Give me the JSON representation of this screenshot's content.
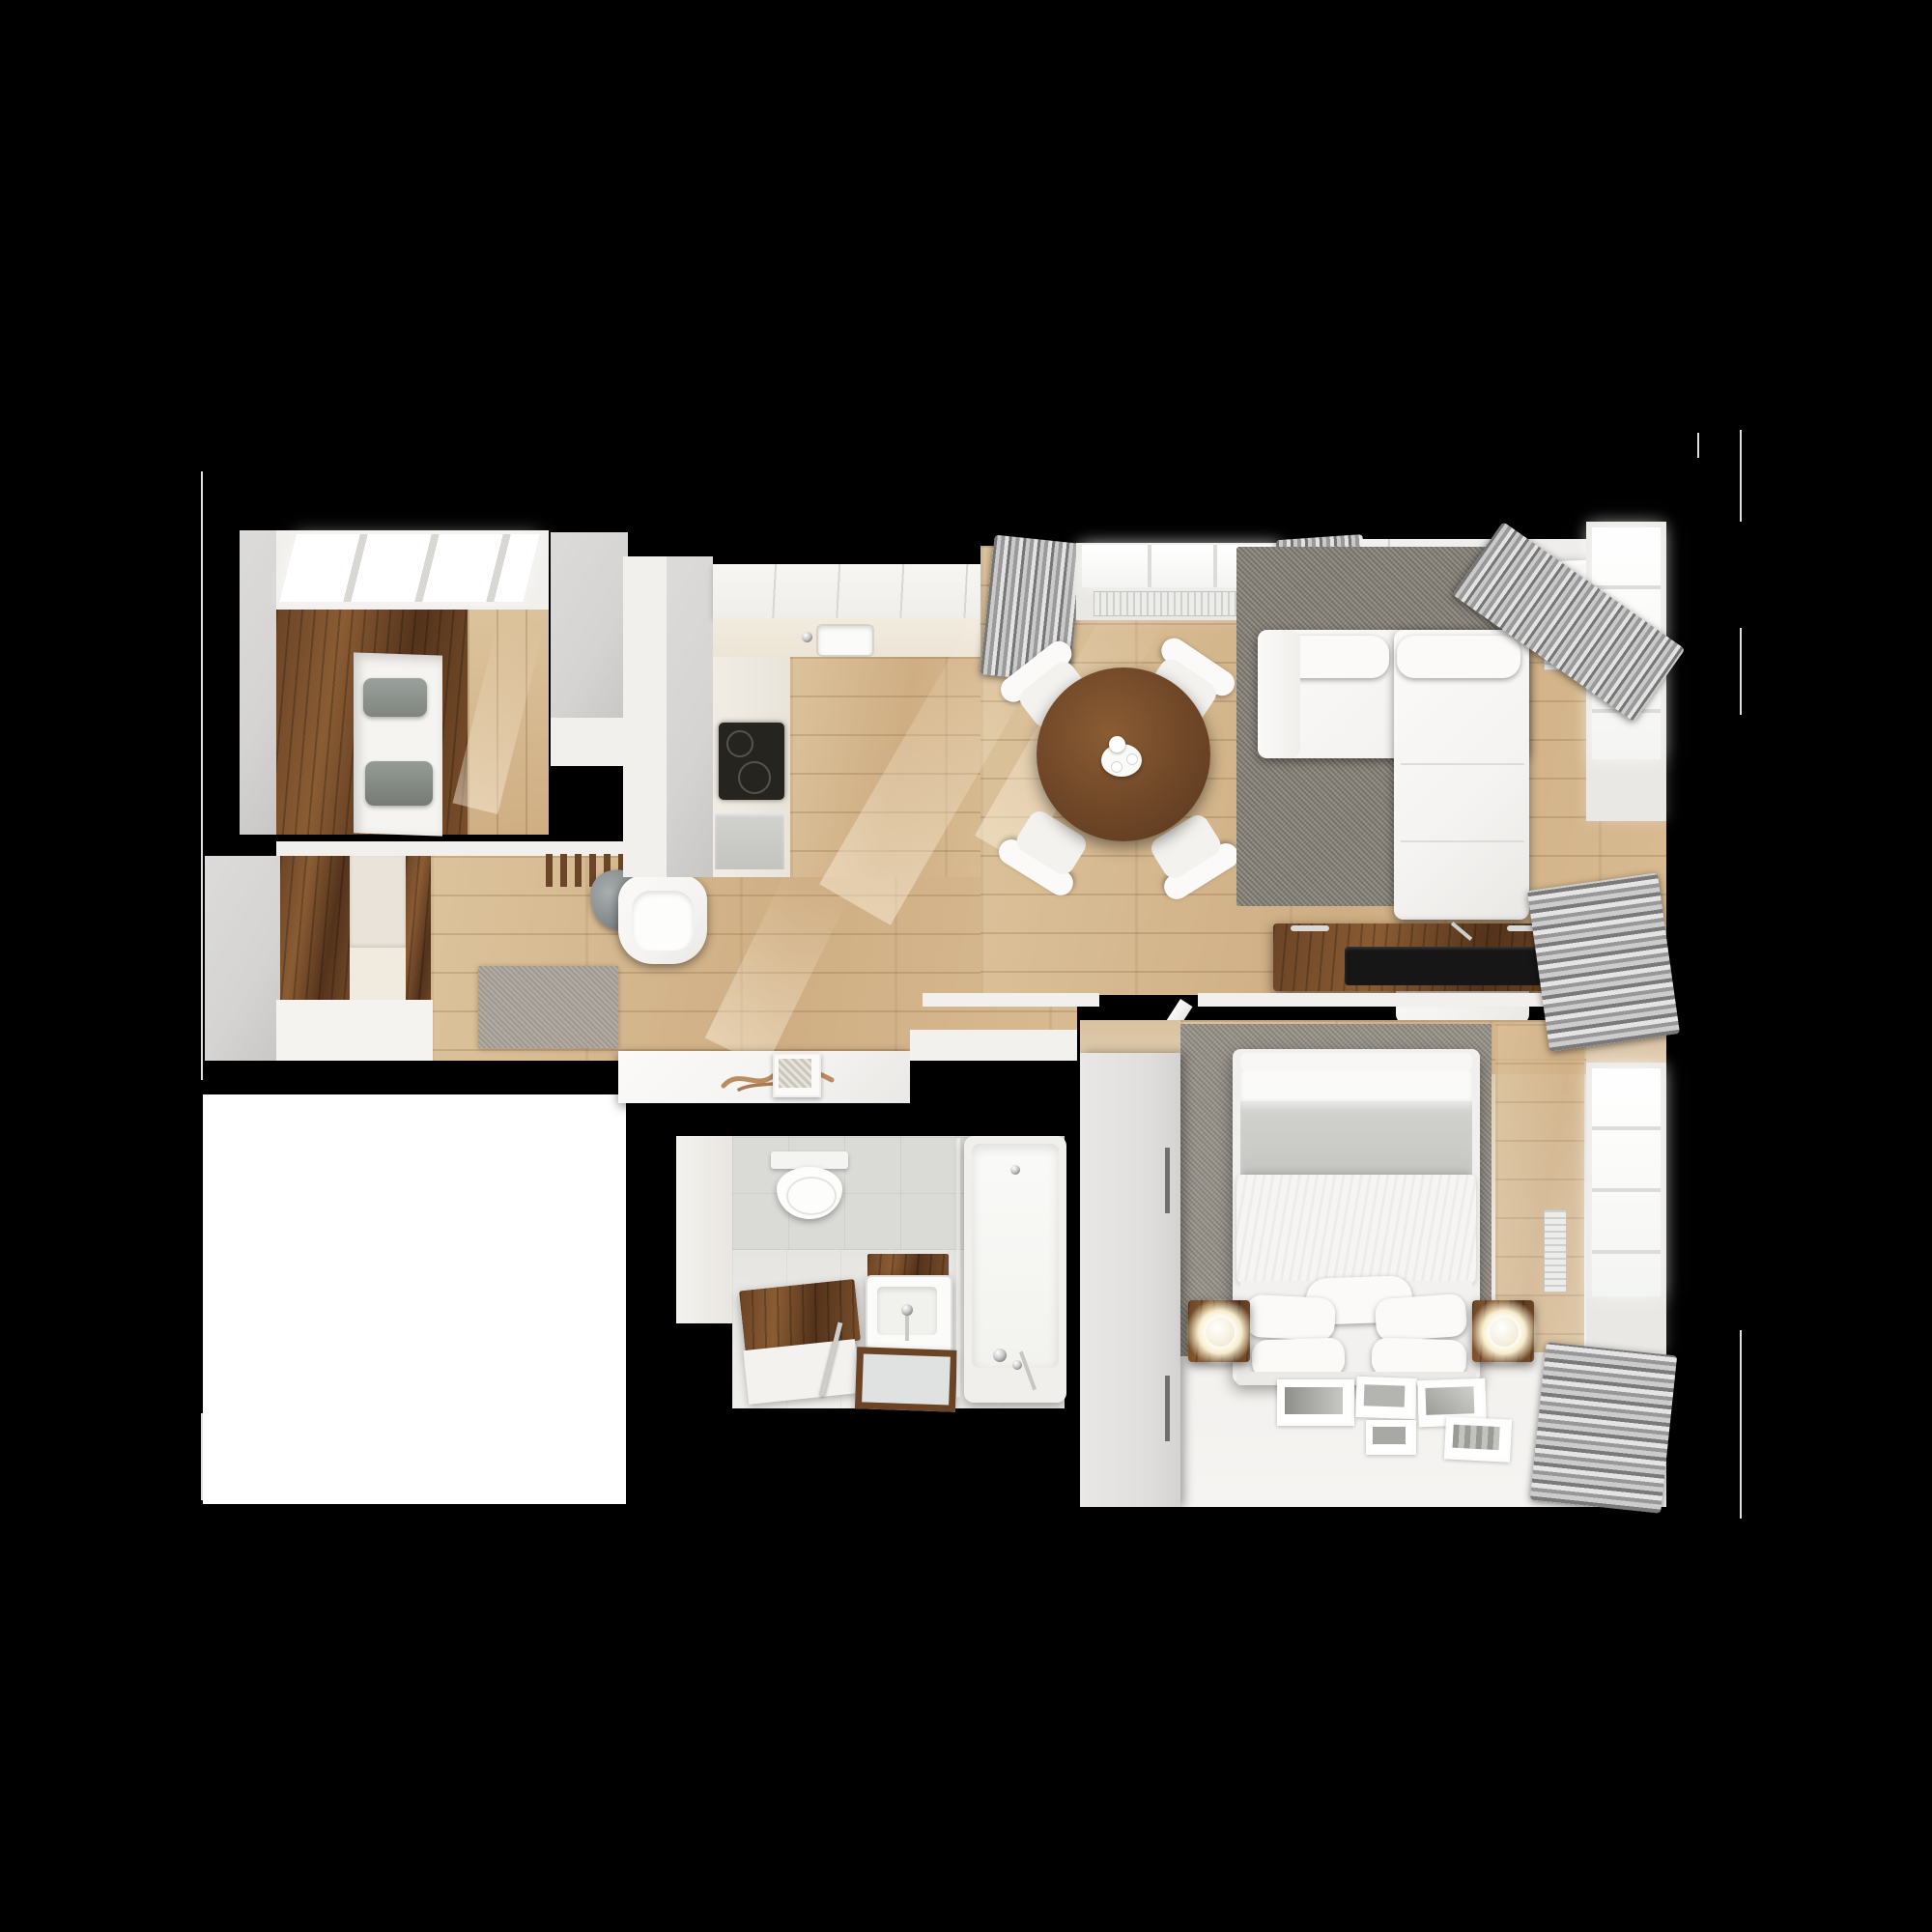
{
  "scene": {
    "title": "Top-down 3D render of an apartment floor plan on a black background",
    "rooms": [
      {
        "id": "closet-room",
        "label": "walk-in closet",
        "furniture": [
          "walnut wardrobe with open shelf niche",
          "folded gray linens",
          "skylight ceiling band",
          "oak floor"
        ]
      },
      {
        "id": "entry-hall",
        "label": "entry hall",
        "furniture": [
          "walnut wardrobe panels",
          "cream cabinet fronts",
          "coat rack with hanging coats",
          "white armchair",
          "hall rug",
          "white console with driftwood decor"
        ]
      },
      {
        "id": "kitchen",
        "label": "kitchen",
        "furniture": [
          "white L-shaped counter",
          "sink with faucet",
          "black cooktop",
          "appliance front"
        ]
      },
      {
        "id": "dining-area",
        "label": "dining area",
        "furniture": [
          "round walnut dining table",
          "four white chairs",
          "tea set"
        ]
      },
      {
        "id": "living-room",
        "label": "living room",
        "furniture": [
          "white sectional sofa with chaise",
          "gray area rug",
          "walnut TV console",
          "flat TV lying on console",
          "chrome pendant lamp",
          "framed botanical wall art",
          "white vase",
          "green plant",
          "window with radiator",
          "gray curtains"
        ]
      },
      {
        "id": "bathroom",
        "label": "bathroom",
        "furniture": [
          "wall-hung toilet",
          "walnut bench",
          "washbasin with walnut shelf",
          "walnut framed mirror",
          "towel rail",
          "bathtub with chrome faucet",
          "glass partition",
          "tall white cabinet"
        ]
      },
      {
        "id": "bedroom",
        "label": "bedroom",
        "furniture": [
          "double bed with white and gray bedding",
          "five pillows",
          "two walnut nightstands",
          "two glowing sphere lamps",
          "white wardrobe",
          "open white door",
          "gray carpet",
          "photo frames on floor",
          "windows with curtains and radiators"
        ]
      }
    ],
    "notes": [
      "black background",
      "white unrendered rectangle at lower left",
      "thin white frame-edge lines at far left and right"
    ]
  },
  "palette": {
    "background": "#000000",
    "floor_oak": "#cfae83",
    "floor_oak_light": "#dcc39c",
    "walnut": "#6b4426",
    "walnut_dark": "#53331b",
    "wall_gray": "#d5d4d2",
    "wall_white": "#f1f0ed",
    "tile_gray": "#dadad7",
    "rug_living": "#8e8a82",
    "rug_bedroom": "#9b968e",
    "rug_hall": "#b3aca4",
    "curtain_gray": "#a9a9a9",
    "sofa_white": "#f4f3f1",
    "tv_black": "#161616",
    "glow_warm": "#fff6e0",
    "plant_green": "#47683a"
  }
}
